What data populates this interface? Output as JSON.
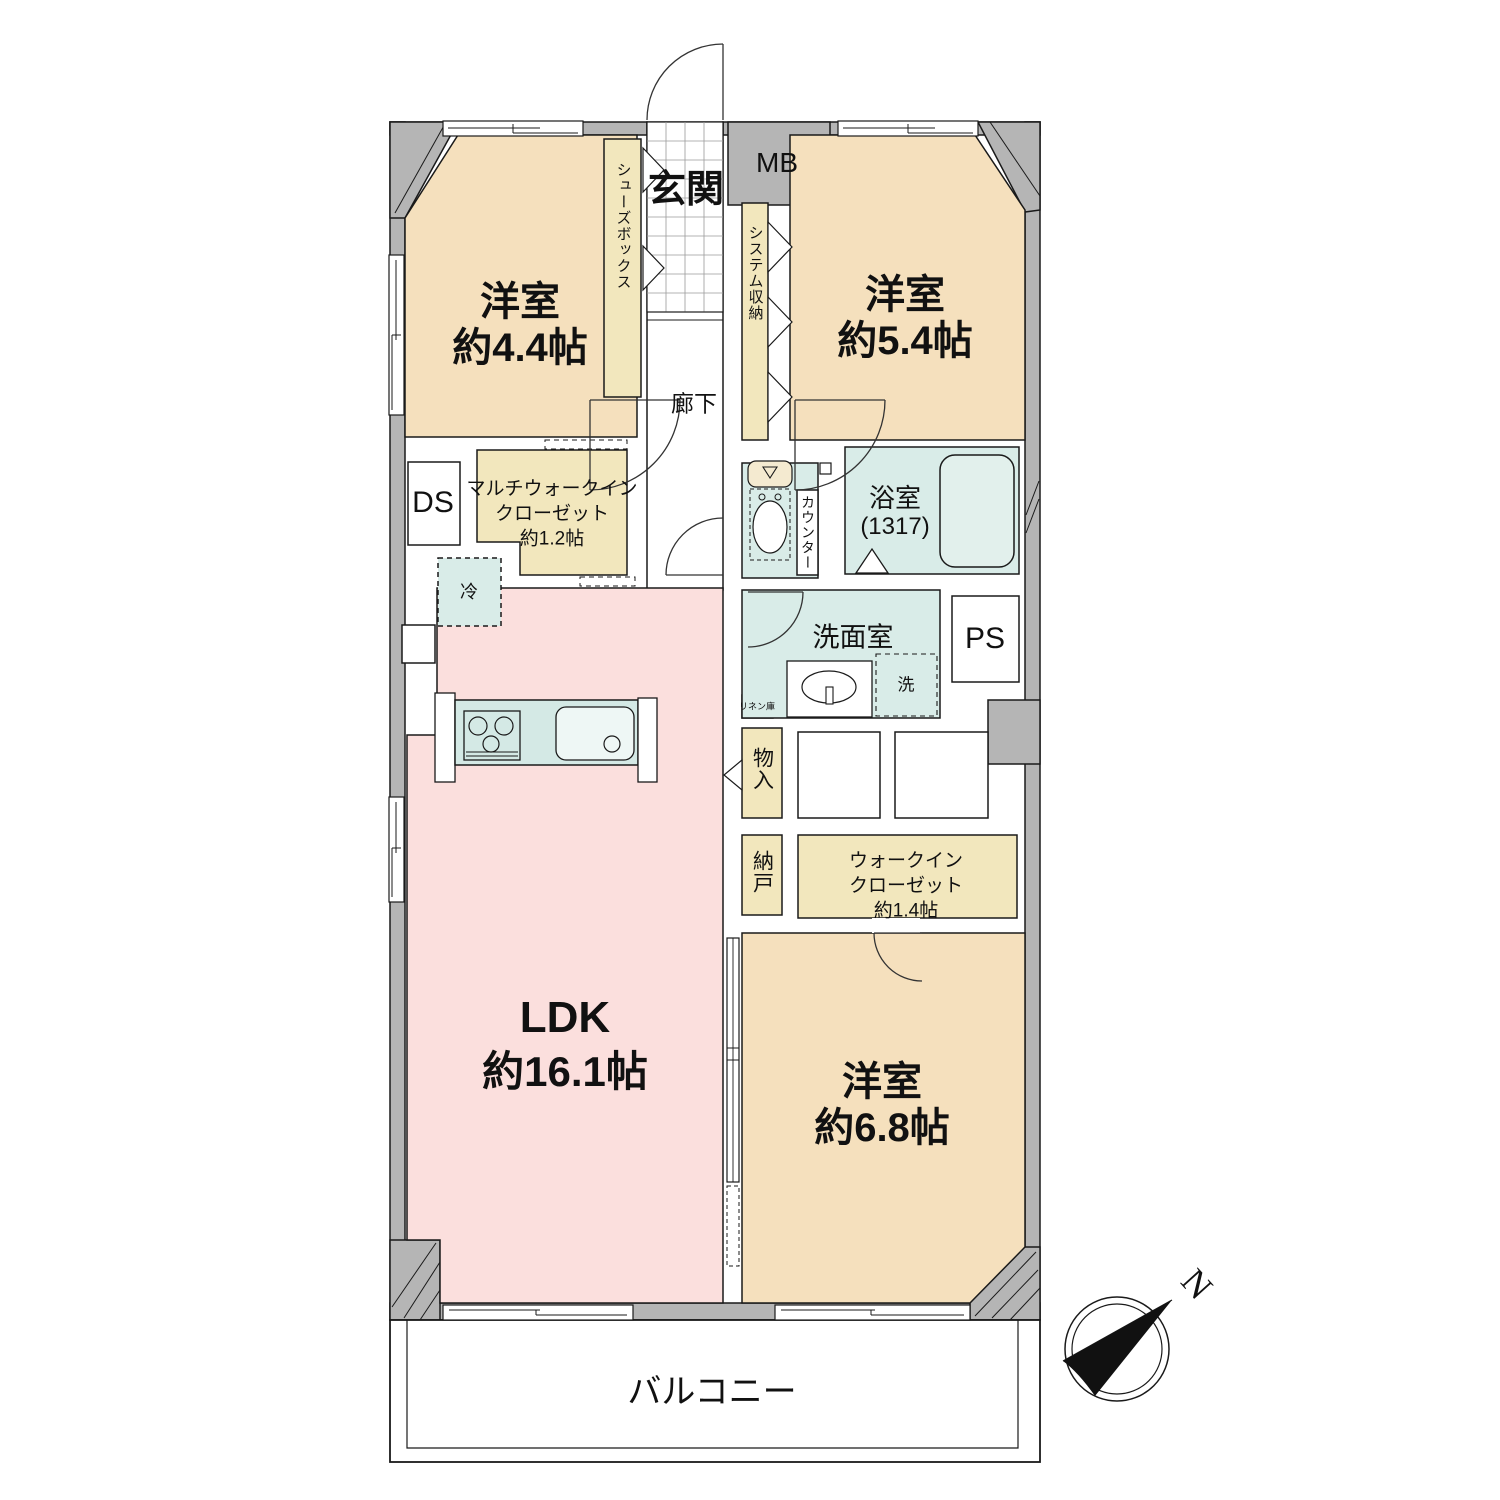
{
  "floorplan": {
    "rooms": {
      "western_room_1": {
        "name": "洋室",
        "size": "約4.4帖"
      },
      "western_room_2": {
        "name": "洋室",
        "size": "約5.4帖"
      },
      "western_room_3": {
        "name": "洋室",
        "size": "約6.8帖"
      },
      "ldk": {
        "name": "LDK",
        "size": "約16.1帖"
      }
    },
    "entrance": {
      "genkan": "玄関",
      "corridor": "廊下",
      "shoe_box": "シューズボックス",
      "meter_box": "MB"
    },
    "storage": {
      "system_storage": "システム収納",
      "multi_wic": [
        "マルチウォークイン",
        "クローゼット",
        "約1.2帖"
      ],
      "wic": [
        "ウォークイン",
        "クローゼット",
        "約1.4帖"
      ],
      "monoire": "物入",
      "nando": "納戸",
      "linen": "リネン庫"
    },
    "wet_areas": {
      "bath": "浴室",
      "bath_size": "(1317)",
      "counter": "カウンター",
      "washroom": "洗面室",
      "washer": "洗",
      "fridge": "冷"
    },
    "shafts": {
      "ds": "DS",
      "ps": "PS"
    },
    "balcony": "バルコニー",
    "compass_north": "N",
    "colors": {
      "room_peach": "#f5e0bd",
      "ldk_pink": "#fbdfdd",
      "wet_blue": "#d9ece8",
      "closet_cream": "#f2e7bd",
      "tank_cream": "#f4ead0",
      "wall_gray": "#b5b5b5",
      "line_black": "#1a1a1a"
    }
  }
}
